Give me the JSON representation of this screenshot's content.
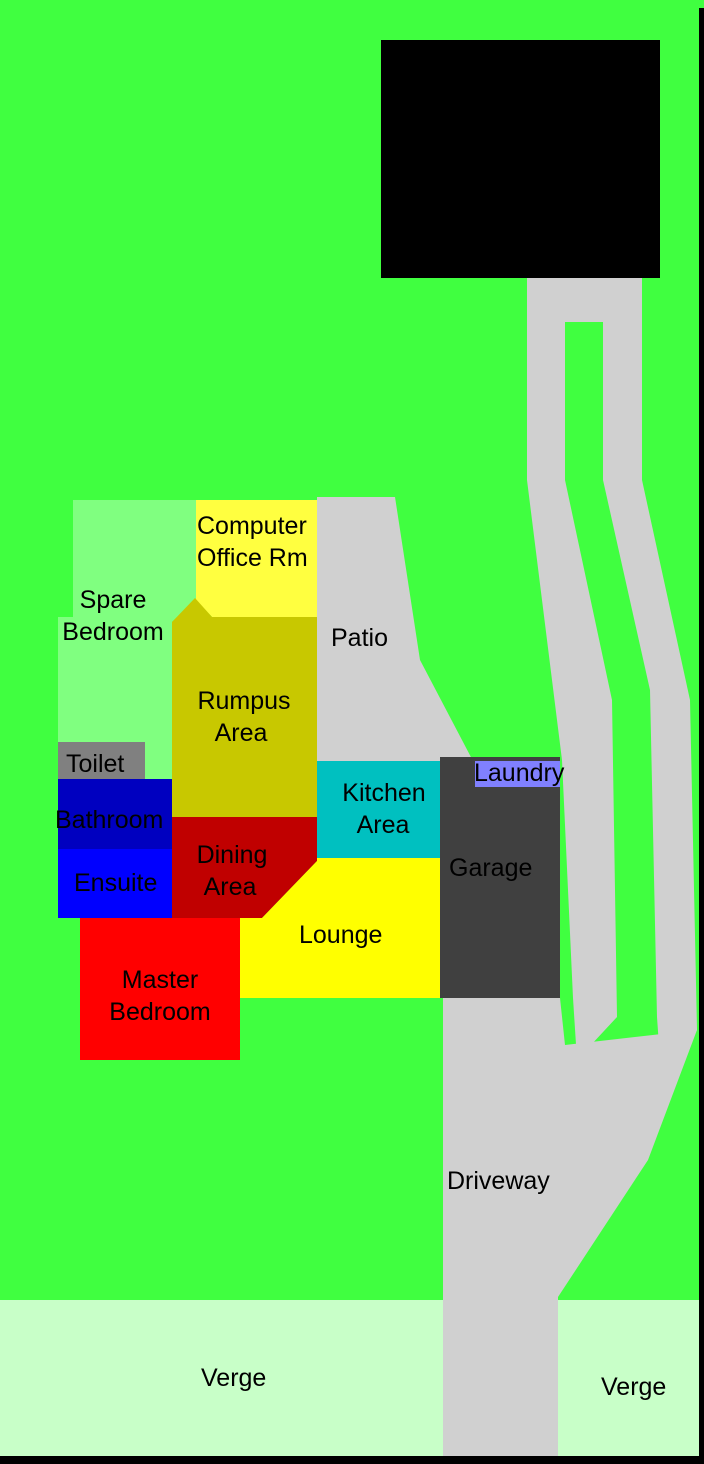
{
  "colors": {
    "grass": "#40FF40",
    "verge": "#C8FFC8",
    "paving": "#D0D0D0",
    "workshop": "#000000",
    "spare_bedroom": "#80FF80",
    "computer_office": "#FFFF40",
    "rumpus": "#C8C800",
    "toilet": "#808080",
    "bathroom": "#0000C0",
    "ensuite": "#0000FF",
    "dining": "#C00000",
    "kitchen": "#00C0C0",
    "lounge": "#FFFF00",
    "master_bedroom": "#FF0000",
    "garage_house": "#404040",
    "laundry": "#8080FF",
    "border": "#000000",
    "label_dark": "#000000",
    "label_workshop": "#E0E0E0",
    "label_workshop_garage": "#C8C8C8",
    "label_garage_house": "#C0C0C0"
  },
  "regions": {
    "workshop": {
      "label": "Workshop"
    },
    "workshop_garage": {
      "label": "Garage"
    },
    "spare_bedroom": {
      "line1": "Spare",
      "line2": "Bedroom"
    },
    "computer_office": {
      "line1": "Computer",
      "line2": "Office Rm"
    },
    "patio": {
      "label": "Patio"
    },
    "rumpus": {
      "line1": "Rumpus",
      "line2": "Area"
    },
    "toilet": {
      "label": "Toilet"
    },
    "bathroom": {
      "label": "Bathroom"
    },
    "ensuite": {
      "label": "Ensuite"
    },
    "dining": {
      "line1": "Dining",
      "line2": "Area"
    },
    "kitchen": {
      "line1": "Kitchen",
      "line2": "Area"
    },
    "laundry": {
      "label": "Laundry"
    },
    "garage_house": {
      "label": "Garage"
    },
    "lounge": {
      "label": "Lounge"
    },
    "master_bedroom": {
      "line1": "Master",
      "line2": "Bedroom"
    },
    "driveway": {
      "label": "Driveway"
    },
    "verge_left": {
      "label": "Verge"
    },
    "verge_right": {
      "label": "Verge"
    }
  }
}
